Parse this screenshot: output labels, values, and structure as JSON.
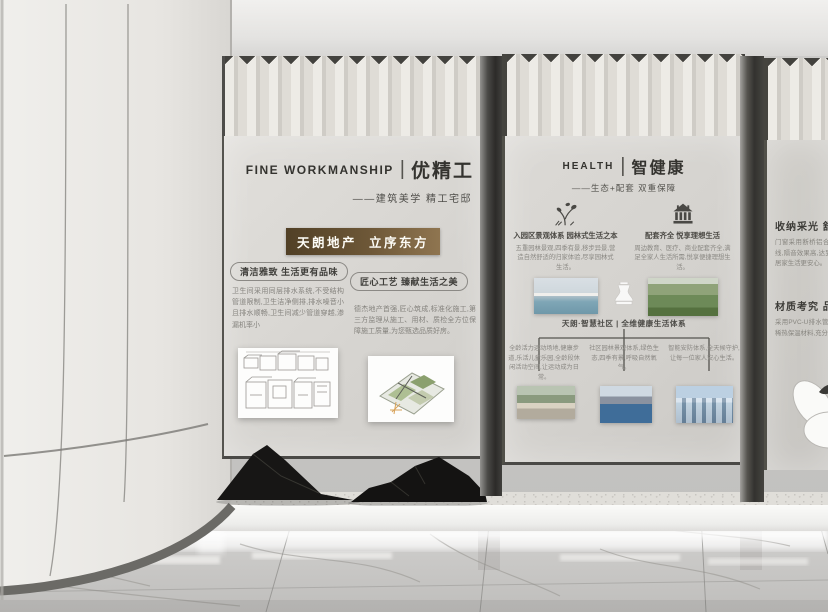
{
  "colors": {
    "badge_gradient_start": "#514026",
    "badge_gradient_end": "#8f7550",
    "panel_background": "#d6d4d0",
    "title_text": "#34332f",
    "body_text": "#85837e"
  },
  "panel_workmanship": {
    "header_en": "FINE WORKMANSHIP",
    "header_sep": "|",
    "header_cn": "优精工",
    "subtitle": "——建筑美学 精工宅邸",
    "badge": "天朗地产  立序东方",
    "section_left": {
      "title": "清洁雅致 生活更有品味",
      "body": "卫生间采用同层排水系统,不受结构管道限制,卫生洁净侧排,排水噪音小且排水顺畅,卫生间减少管道穿越,渗漏机率小"
    },
    "section_right": {
      "title": "匠心工艺 臻献生活之美",
      "body": "德杰地产首强,匠心筑成,标准化施工,第三方监理从施工、用材、质检全方位保障施工质量,为您甄选品质好房。"
    }
  },
  "panel_health": {
    "header_en": "HEALTH",
    "header_sep": "|",
    "header_cn": "智健康",
    "subtitle": "——生态+配套 双重保障",
    "features": [
      {
        "icon": "tree-icon",
        "title": "入园区景观体系 园林式生活之本",
        "body": "五重园林景观,四季有景,移步异景,营造自然舒适的归家体验,尽享园林式生活。"
      },
      {
        "icon": "pavilion-icon",
        "title": "配套齐全 悦享理想生活",
        "body": "周边教育、医疗、商业配套齐全,满足全家人生活所需,悦享便捷理想生活。"
      }
    ],
    "system": {
      "title": "天朗·智慧社区 | 全维健康生活体系",
      "branches": [
        "全龄活力运动场地,健康步道,乐活儿童乐园,全龄段休闲活动空间,让运动成为日常。",
        "社区园林景观体系,绿色生态,四季有景,呼吸自然氧气。",
        "智能安防体系,全天候守护,让每一位家人安心生活。"
      ]
    }
  },
  "panel_detail": {
    "heading_light": "收纳采光 舒享空间",
    "body_light": "门窗采用断桥铝合金,有效隔离有害紫外线,隔音效果高,达到国家节能安全标准,让居家生活更安心。",
    "heading_material": "材质考究 品质严选",
    "body_material": "采用PVC-U排水管,隔层、防腐、阻力小,稀热保温材料,充分让建筑品质经久耐用。"
  }
}
